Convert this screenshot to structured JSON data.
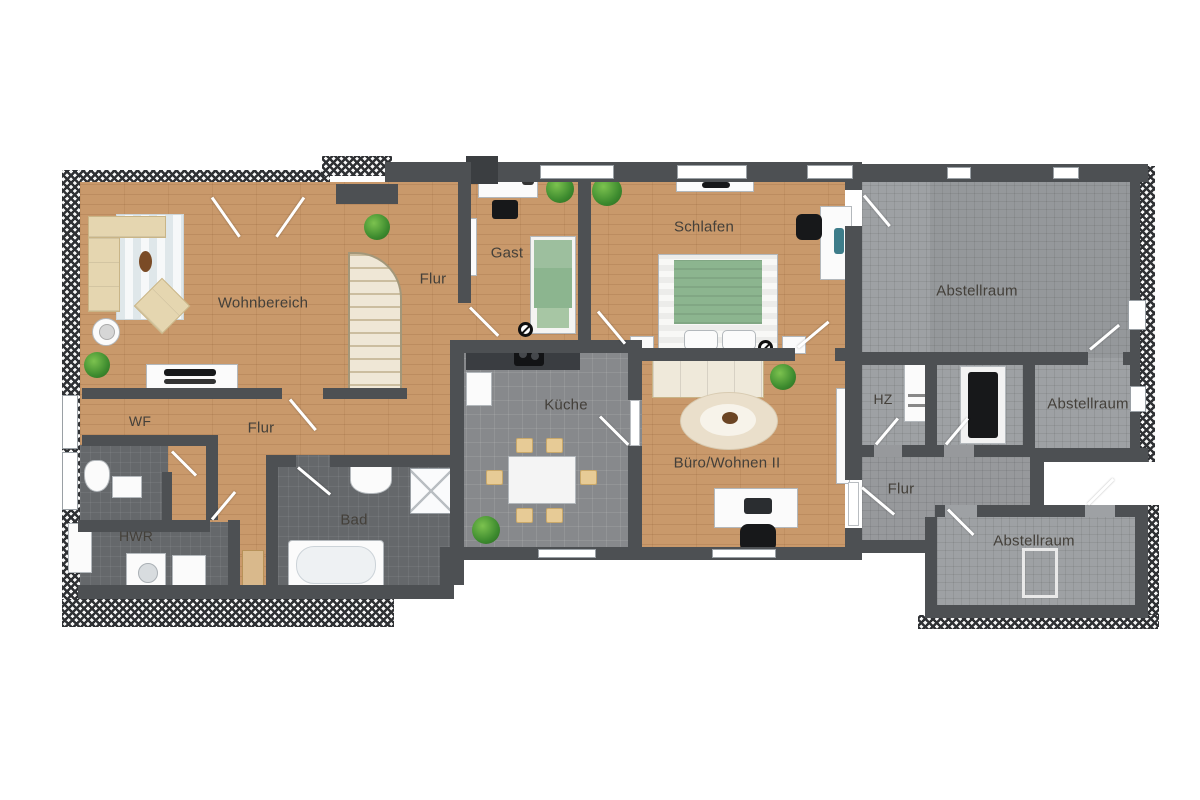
{
  "rooms": [
    {
      "id": "wohnbereich",
      "label": "Wohnbereich"
    },
    {
      "id": "flur-stairs",
      "label": "Flur"
    },
    {
      "id": "gast",
      "label": "Gast"
    },
    {
      "id": "schlafen",
      "label": "Schlafen"
    },
    {
      "id": "abstellraum-top",
      "label": "Abstellraum"
    },
    {
      "id": "hz",
      "label": "HZ"
    },
    {
      "id": "abstellraum-mid",
      "label": "Abstellraum"
    },
    {
      "id": "kueche",
      "label": "Küche"
    },
    {
      "id": "buero-wohnen",
      "label": "Büro/Wohnen II"
    },
    {
      "id": "wf",
      "label": "WF"
    },
    {
      "id": "flur-main",
      "label": "Flur"
    },
    {
      "id": "flur-right",
      "label": "Flur"
    },
    {
      "id": "hwr",
      "label": "HWR"
    },
    {
      "id": "bad",
      "label": "Bad"
    },
    {
      "id": "abstellraum-bottom",
      "label": "Abstellraum"
    }
  ],
  "colors": {
    "wood_floor": "#c9996b",
    "bath_tile": "#65686b",
    "kitchen_tile": "#87898c",
    "storage_tile": "#9ea1a4",
    "wall": "#4d5053",
    "roof_hatch": "#2f3134",
    "bed_green": "#8cb58f",
    "sofa_beige": "#e5d6b0",
    "plant_green": "#3c8a2e"
  },
  "icons": {
    "plant": "potted-plant-icon",
    "door": "door-swing-icon",
    "lamp": "lamp-symbol-icon"
  }
}
